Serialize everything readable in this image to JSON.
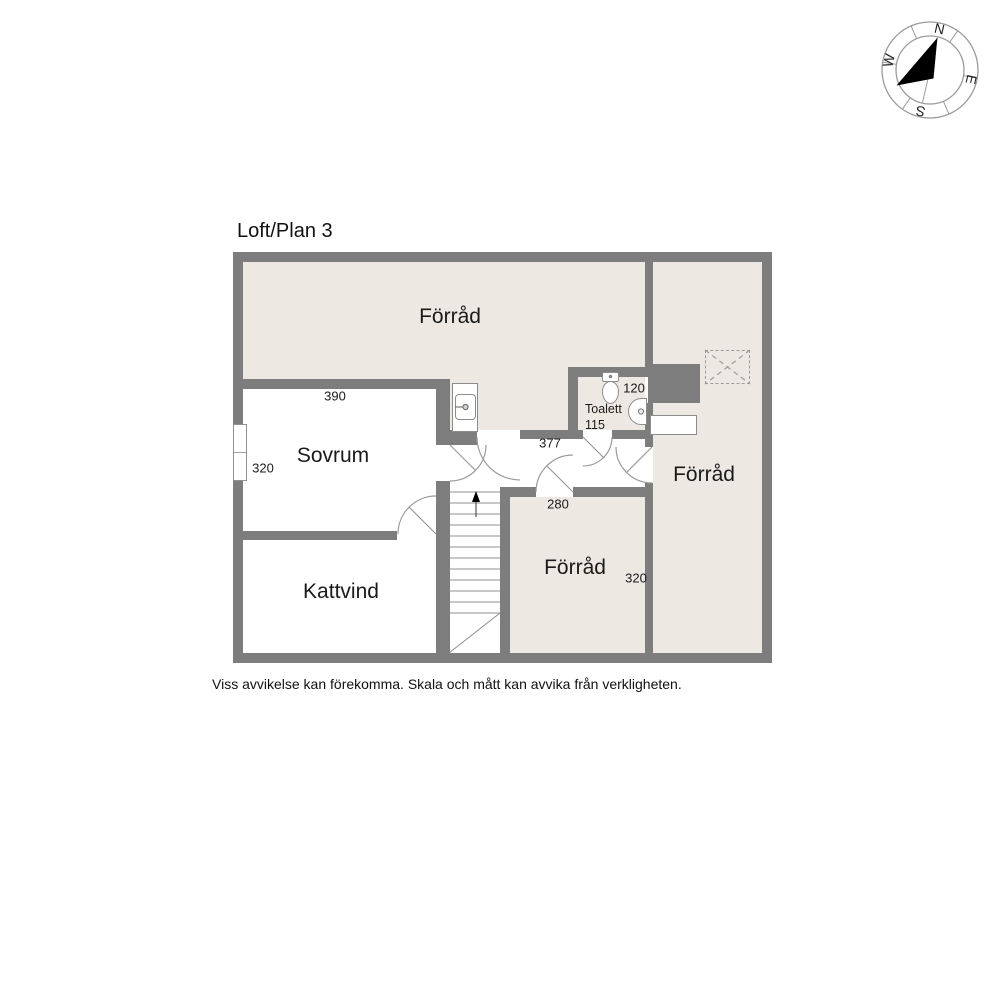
{
  "title": "Loft/Plan 3",
  "disclaimer": "Viss avvikelse kan förekomma. Skala och mått kan avvika från verkligheten.",
  "compass": {
    "north": "N",
    "east": "E",
    "south": "S",
    "west": "W"
  },
  "rooms": {
    "forrad_top": {
      "label": "Förråd"
    },
    "sovrum": {
      "label": "Sovrum",
      "width_cm": "390",
      "depth_cm": "320"
    },
    "kattvind": {
      "label": "Kattvind"
    },
    "toalett": {
      "label": "Toalett",
      "width_cm": "120",
      "depth_cm": "115"
    },
    "hall": {
      "width_cm": "377"
    },
    "forrad_bottom": {
      "label": "Förråd",
      "width_cm": "280",
      "depth_cm": "320"
    },
    "forrad_right": {
      "label": "Förråd"
    }
  },
  "colors": {
    "wall": "#7d7d7d",
    "floor_light": "#ede9e2",
    "room_white": "#ffffff",
    "line": "#9a9a9a",
    "text": "#1a1a1a"
  }
}
